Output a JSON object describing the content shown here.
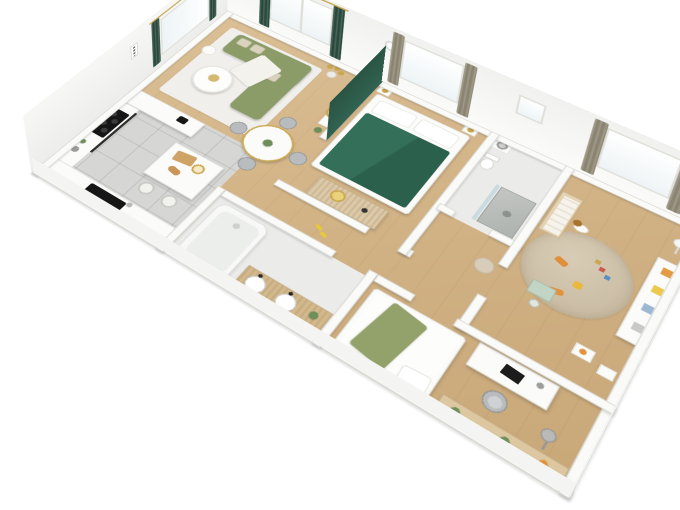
{
  "scene": {
    "type": "isometric 3D floor plan rendering",
    "description": "Bird's-eye cutaway 3D render of a furnished apartment on a white background",
    "background": "#ffffff",
    "floors": [
      "light oak wood",
      "grey ceramic tile (kitchen)",
      "light tile (bathroom and shower room)"
    ]
  },
  "palette": {
    "wood-a": "#dcc096",
    "wood-b": "#c9a878",
    "tile": "#d6d6d4",
    "bath-floor": "#ebebe9",
    "wall": "#fafaf8",
    "sofa-green": "#8b9c68",
    "bed-green": "#2f6550",
    "accent-wall-green": "#2d5a49",
    "curtain-dark": "#2a4a3d",
    "curtain-taupe": "#8b8470",
    "gold": "#c9a850",
    "rug-white": "#f0efeb",
    "rug-kids": "#cfc3ac",
    "wood-furniture": "#dcc9a8",
    "counter-white": "#fbfbf9",
    "appliance-black": "#161616",
    "chair-grey": "#b9bcbe"
  },
  "rooms": [
    {
      "id": "living-dining-room",
      "floor": "wood",
      "furniture": [
        "l-shaped olive sectional sofa",
        "beige cushions",
        "white throw blanket",
        "white round coffee table",
        "white area rug",
        "gold multi-head floor lamp",
        "round dining table with gold legs",
        "four grey dining chairs",
        "console table",
        "round gold wall mirror",
        "dark green curtains",
        "corner windows",
        "small plant"
      ]
    },
    {
      "id": "kitchen",
      "floor": "grey tile",
      "furniture": [
        "l-shaped white counter",
        "black induction cooktop",
        "black sink with faucet",
        "dark counter edge",
        "tall cabinets",
        "kitchen island",
        "cutting board",
        "fruit bowl",
        "two bar stools",
        "bottles"
      ]
    },
    {
      "id": "master-bedroom",
      "floor": "wood",
      "furniture": [
        "double bed with dark green duvet",
        "white pillows",
        "dark green accent headboard wall",
        "two nightstands with gold lamps",
        "ribbed wood sideboard",
        "gold decorative tray",
        "wall clock",
        "window with taupe curtains"
      ]
    },
    {
      "id": "shower-room",
      "floor": "light tile",
      "furniture": [
        "marble shower enclosure",
        "glass panel",
        "toilet",
        "washing machine",
        "small square window"
      ]
    },
    {
      "id": "kids-room",
      "floor": "wood",
      "furniture": [
        "round textured beige rug",
        "plush dog",
        "orange toy",
        "yellow toy",
        "building blocks",
        "tiger toy",
        "wooden crib",
        "white shelf unit with toy bins",
        "mint kids table and chair",
        "white floor lamp",
        "play table",
        "window with taupe curtains"
      ]
    },
    {
      "id": "bathroom",
      "floor": "light tile",
      "furniture": [
        "white bathtub",
        "wood double-sink vanity",
        "two round basins",
        "black faucets",
        "plant"
      ]
    },
    {
      "id": "bedroom-2",
      "floor": "wood",
      "furniture": [
        "single bed with olive green throw",
        "white pillow",
        "white desk",
        "black laptop",
        "grey desk chair",
        "grey floor lamp",
        "wood wall shelf with plants"
      ]
    },
    {
      "id": "hallway",
      "floor": "wood",
      "furniture": [
        "round beige pouf",
        "yellow slippers"
      ]
    }
  ],
  "exterior": {
    "walls": "white cutaway walls, tall at back, low at front",
    "plaque": "small white wall panel"
  }
}
